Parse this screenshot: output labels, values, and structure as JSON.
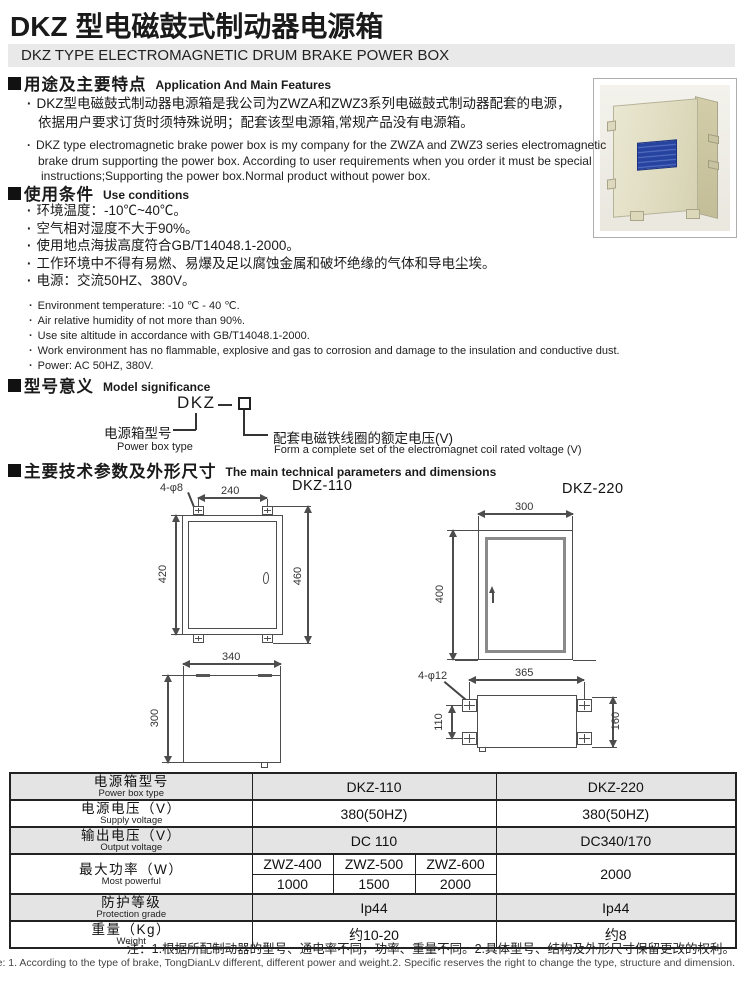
{
  "header": {
    "title": "DKZ 型电磁鼓式制动器电源箱",
    "subtitle": "DKZ TYPE ELECTROMAGNETIC DRUM BRAKE POWER BOX"
  },
  "glyphs": {
    "bullet": "·"
  },
  "features": {
    "heading_cn": "用途及主要特点",
    "heading_en": "Application And Main Features",
    "cn": [
      "DKZ型电磁鼓式制动器电源箱是我公司为ZWZA和ZWZ3系列电磁鼓式制动器配套的电源，",
      "依据用户要求订货时须特殊说明；配套该型电源箱,常规产品没有电源箱。"
    ],
    "en": [
      "DKZ type electromagnetic brake power box is my company for the ZWZA and ZWZ3 series electromagnetic",
      "brake drum supporting the power box. According to user requirements when you order it must be special",
      "instructions;Supporting the power box.Normal product without power box."
    ]
  },
  "conditions": {
    "heading_cn": "使用条件",
    "heading_en": "Use conditions",
    "cn": [
      "环境温度：-10℃~40℃。",
      "空气相对湿度不大于90%。",
      "使用地点海拔高度符合GB/T14048.1-2000。",
      "工作环境中不得有易燃、易爆及足以腐蚀金属和破坏绝缘的气体和导电尘埃。",
      "电源：交流50HZ、380V。"
    ],
    "en": [
      "Environment temperature: -10 ℃ - 40 ℃.",
      "Air relative humidity of not more than 90%.",
      "Use site altitude in accordance with GB/T14048.1-2000.",
      "Work environment has no flammable, explosive and gas to corrosion and damage to the insulation and conductive dust.",
      "Power: AC 50HZ, 380V."
    ]
  },
  "model": {
    "heading_cn": "型号意义",
    "heading_en": "Model  significance",
    "code": "DKZ",
    "left_cn": "电源箱型号",
    "left_en": "Power box type",
    "right_cn": "配套电磁铁线圈的额定电压(V)",
    "right_en": "Form a complete set of the electromagnet coil rated voltage (V)"
  },
  "tech": {
    "heading_cn": "主要技术参数及外形尺寸",
    "heading_en": "The main technical parameters and dimensions",
    "d110": {
      "label": "DKZ-110",
      "hole": "4-φ8",
      "front": {
        "w_top": "240",
        "h_left": "420",
        "h_right": "460"
      },
      "bottom": {
        "w": "340",
        "h": "300"
      }
    },
    "d220": {
      "label": "DKZ-220",
      "hole": "4-φ12",
      "front": {
        "w": "300",
        "h": "400"
      },
      "bottom": {
        "w": "365",
        "h_left": "110",
        "h_right": "160"
      }
    }
  },
  "table": {
    "rows": [
      {
        "cn": "电源箱型号",
        "en": "Power box type",
        "v110": "DKZ-110",
        "v220": "DKZ-220"
      },
      {
        "cn": "电源电压（V）",
        "en": "Supply voltage",
        "v110": "380(50HZ)",
        "v220": "380(50HZ)"
      },
      {
        "cn": "输出电压（V）",
        "en": "Output voltage",
        "v110": "DC 110",
        "v220": "DC340/170"
      },
      {
        "cn": "最大功率（W）",
        "en": "Most powerful",
        "sub_headers": [
          "ZWZ-400",
          "ZWZ-500",
          "ZWZ-600"
        ],
        "sub_values": [
          "1000",
          "1500",
          "2000"
        ],
        "v220": "2000"
      },
      {
        "cn": "防护等级",
        "en": "Protection grade",
        "v110": "Ip44",
        "v220": "Ip44"
      },
      {
        "cn": "重量（Kg）",
        "en": "Weight",
        "v110": "约10-20",
        "v220": "约8"
      }
    ],
    "note_cn": "注：1.根据所配制动器的型号、通电率不同，功率、重量不同。2.具体型号、结构及外形尺寸保留更改的权利。",
    "note_en": "Note: 1. According to the type of brake, TongDianLv different, different power and weight.2. Specific reserves the right to change the type, structure and dimension."
  }
}
